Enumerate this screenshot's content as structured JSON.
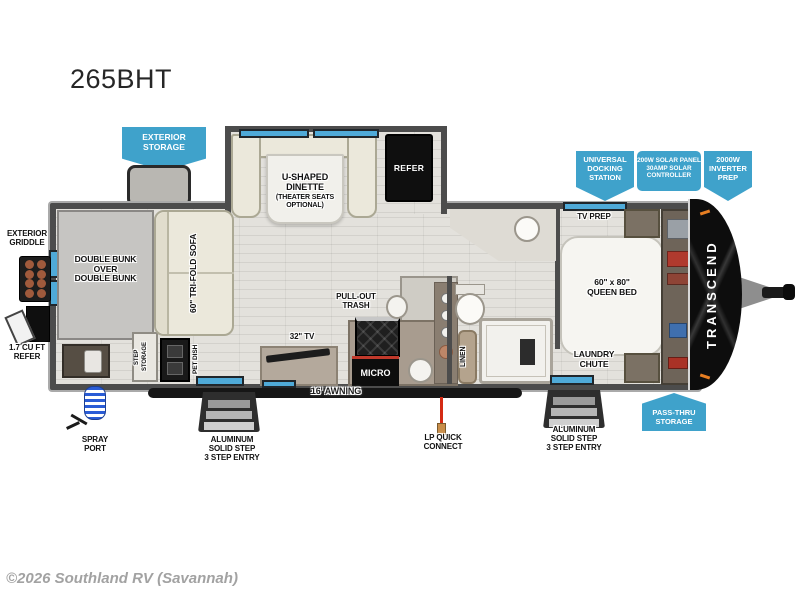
{
  "title": "265BHT",
  "copyright": "©2026 Southland RV (Savannah)",
  "colors": {
    "callout_blue": "#3fa2cb",
    "window_blue": "#4faad8",
    "wall_gray": "#4c4c4c",
    "floor_gray": "#e3e1dc",
    "accent_red": "#d42a14",
    "cap_black": "#0d0d0d"
  },
  "callouts": {
    "exterior_storage": "EXTERIOR\nSTORAGE",
    "universal_docking": "UNIVERSAL\nDOCKING\nSTATION",
    "solar": "200W SOLAR PANEL\n30AMP SOLAR\nCONTROLLER",
    "inverter": "2000W\nINVERTER\nPREP",
    "pass_thru": "PASS-THRU\nSTORAGE"
  },
  "labels": {
    "dinette": "U-SHAPED\nDINETTE",
    "dinette_sub": "(THEATER SEATS\nOPTIONAL)",
    "refer": "REFER",
    "tv_prep": "TV PREP",
    "queen_bed": "60\" x 80\"\nQUEEN BED",
    "laundry_chute": "LAUNDRY\nCHUTE",
    "brand": "TRANSCEND",
    "exterior_griddle": "EXTERIOR\nGRIDDLE",
    "double_bunk": "DOUBLE BUNK\nOVER\nDOUBLE BUNK",
    "mini_refer": "1.7 CU FT\nREFER",
    "sofa": "60\" TRI-FOLD SOFA",
    "step_storage": "STEP\nSTORAGE",
    "pet_dish": "PET DISH",
    "pull_out_trash": "PULL-OUT\nTRASH",
    "tv_32": "32\" TV",
    "micro": "MICRO",
    "linen": "LINEN",
    "spray_port": "SPRAY\nPORT",
    "step_entry_left": "ALUMINUM\nSOLID STEP\n3 STEP ENTRY",
    "step_entry_right": "ALUMINUM\nSOLID STEP\n3 STEP ENTRY",
    "awning": "16' AWNING",
    "lp_quick": "LP QUICK\nCONNECT"
  }
}
